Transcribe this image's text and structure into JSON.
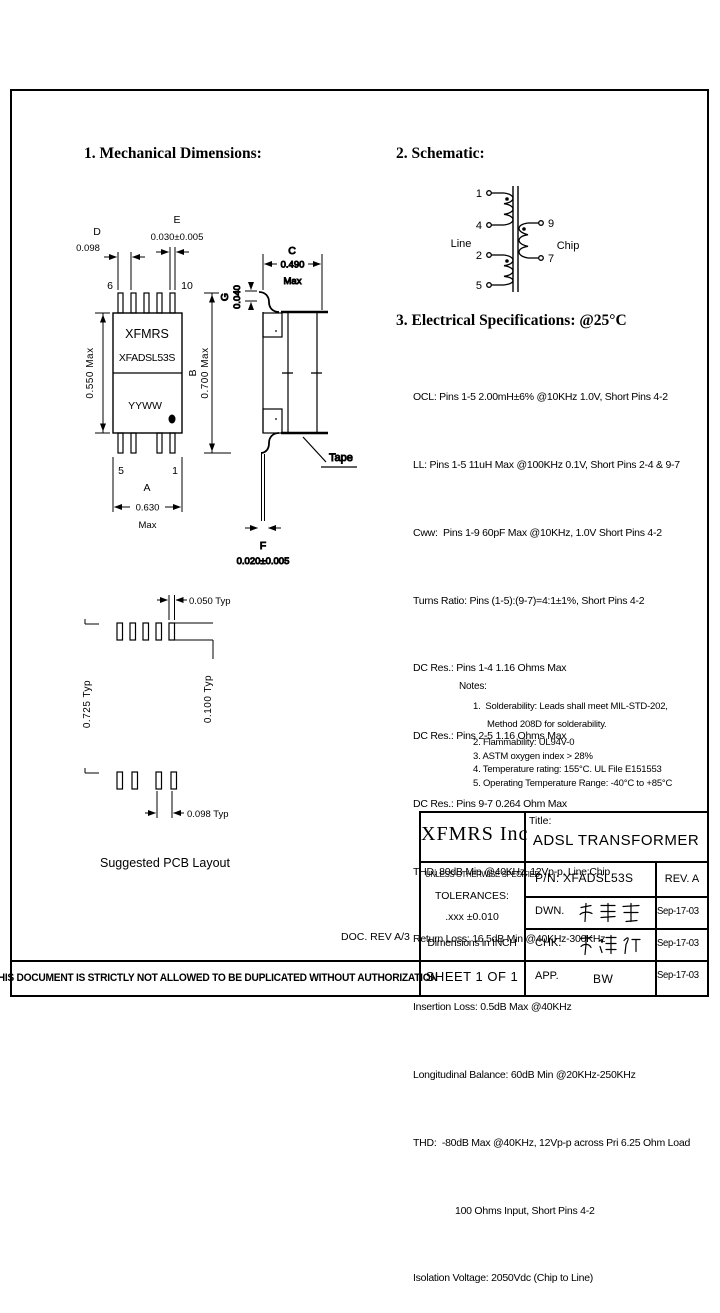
{
  "sections": {
    "mechanical_heading": "1. Mechanical Dimensions:",
    "schematic_heading": "2. Schematic:",
    "electrical_heading": "3. Electrical Specifications: @25°C"
  },
  "schematic": {
    "left_label": "Line",
    "right_label": "Chip",
    "pin1": "1",
    "pin4": "4",
    "pin2": "2",
    "pin5": "5",
    "pin9": "9",
    "pin7": "7"
  },
  "mech": {
    "marking": {
      "line1": "XFMRS",
      "line2": "XFADSL53S",
      "line3": "YYWW"
    },
    "pins": {
      "top_left": "6",
      "top_right": "10",
      "bottom_left": "5",
      "bottom_right": "1"
    },
    "dims": {
      "d_letter": "D",
      "d_value": "0.098",
      "e_letter": "E",
      "e_value": "0.030±0.005",
      "height_left": "0.550  Max",
      "b_letter": "B",
      "b_value": "0.700  Max",
      "a_letter": "A",
      "a_value": "0.630",
      "a_max": "Max",
      "c_letter": "C",
      "c_value": "0.490",
      "c_max": "Max",
      "g_letter": "G",
      "g_value": "0.040",
      "f_letter": "F",
      "f_value": "0.020±0.005",
      "tape_label": "Tape"
    },
    "pcb": {
      "caption": "Suggested PCB Layout",
      "pad_width": "0.050 Typ",
      "pitch_vert": "0.100  Typ",
      "row_span": "0.725  Typ",
      "pad_pitch": "0.098 Typ"
    }
  },
  "electrical": {
    "lines": [
      "OCL: Pins 1-5 2.00mH±6% @10KHz 1.0V, Short Pins 4-2",
      "LL: Pins 1-5 11uH Max @100KHz 0.1V, Short Pins 2-4 & 9-7",
      "Cww:  Pins 1-9 60pF Max @10KHz, 1.0V Short Pins 4-2",
      "Turns Ratio: Pins (1-5):(9-7)=4:1±1%, Short Pins 4-2",
      "DC Res.: Pins 1-4 1.16 Ohms Max",
      "DC Res.: Pins 2-5 1.16 Ohms Max",
      "DC Res.: Pins 9-7 0.264 Ohm Max",
      "THD: 80dB Min @40KHz, 12Vp-p, Line:Chip",
      "Return Loss: 16.5dB Min @40KHz-300KHz",
      "Insertion Loss: 0.5dB Max @40KHz",
      "Longitudinal Balance: 60dB Min @20KHz-250KHz",
      "THD:  -80dB Max @40KHz, 12Vp-p across Pri 6.25 Ohm Load",
      "100 Ohms Input, Short Pins 4-2",
      "Isolation Voltage: 2050Vdc (Chip to Line)"
    ]
  },
  "notes": {
    "heading": "Notes:",
    "lines": [
      "1.  Solderability: Leads shall meet MIL-STD-202,",
      "Method 208D for solderability.",
      "2. Flammability: UL94V-0",
      "3. ASTM oxygen index > 28%",
      "4. Temperature rating: 155°C. UL File E151553",
      "5. Operating Temperature Range: -40°C to +85°C"
    ]
  },
  "title_block": {
    "company": "XFMRS Inc",
    "title_label": "Title:",
    "title": "ADSL TRANSFORMER",
    "spec_note": {
      "line1": "UNLESS OTHERWISE SPECIFIED",
      "line2": "TOLERANCES:",
      "line3": ".xxx ±0.010",
      "line4": "Dimensions in INCH"
    },
    "part_number": "P/N: XFADSL53S",
    "revision": "REV. A",
    "dwn": {
      "label": "DWN.",
      "signature": "廖玉甫",
      "date": "Sep-17-03"
    },
    "chk": {
      "label": "CHK.",
      "signature": "李清仁",
      "date": "Sep-17-03"
    },
    "app": {
      "label": "APP.",
      "signature": "BW",
      "date": "Sep-17-03"
    },
    "sheet": "SHEET 1 OF 1"
  },
  "footer": {
    "disclaimer": "THIS DOCUMENT IS STRICTLY NOT ALLOWED TO BE DUPLICATED WITHOUT AUTHORIZATION",
    "doc_rev": "DOC. REV A/3"
  }
}
